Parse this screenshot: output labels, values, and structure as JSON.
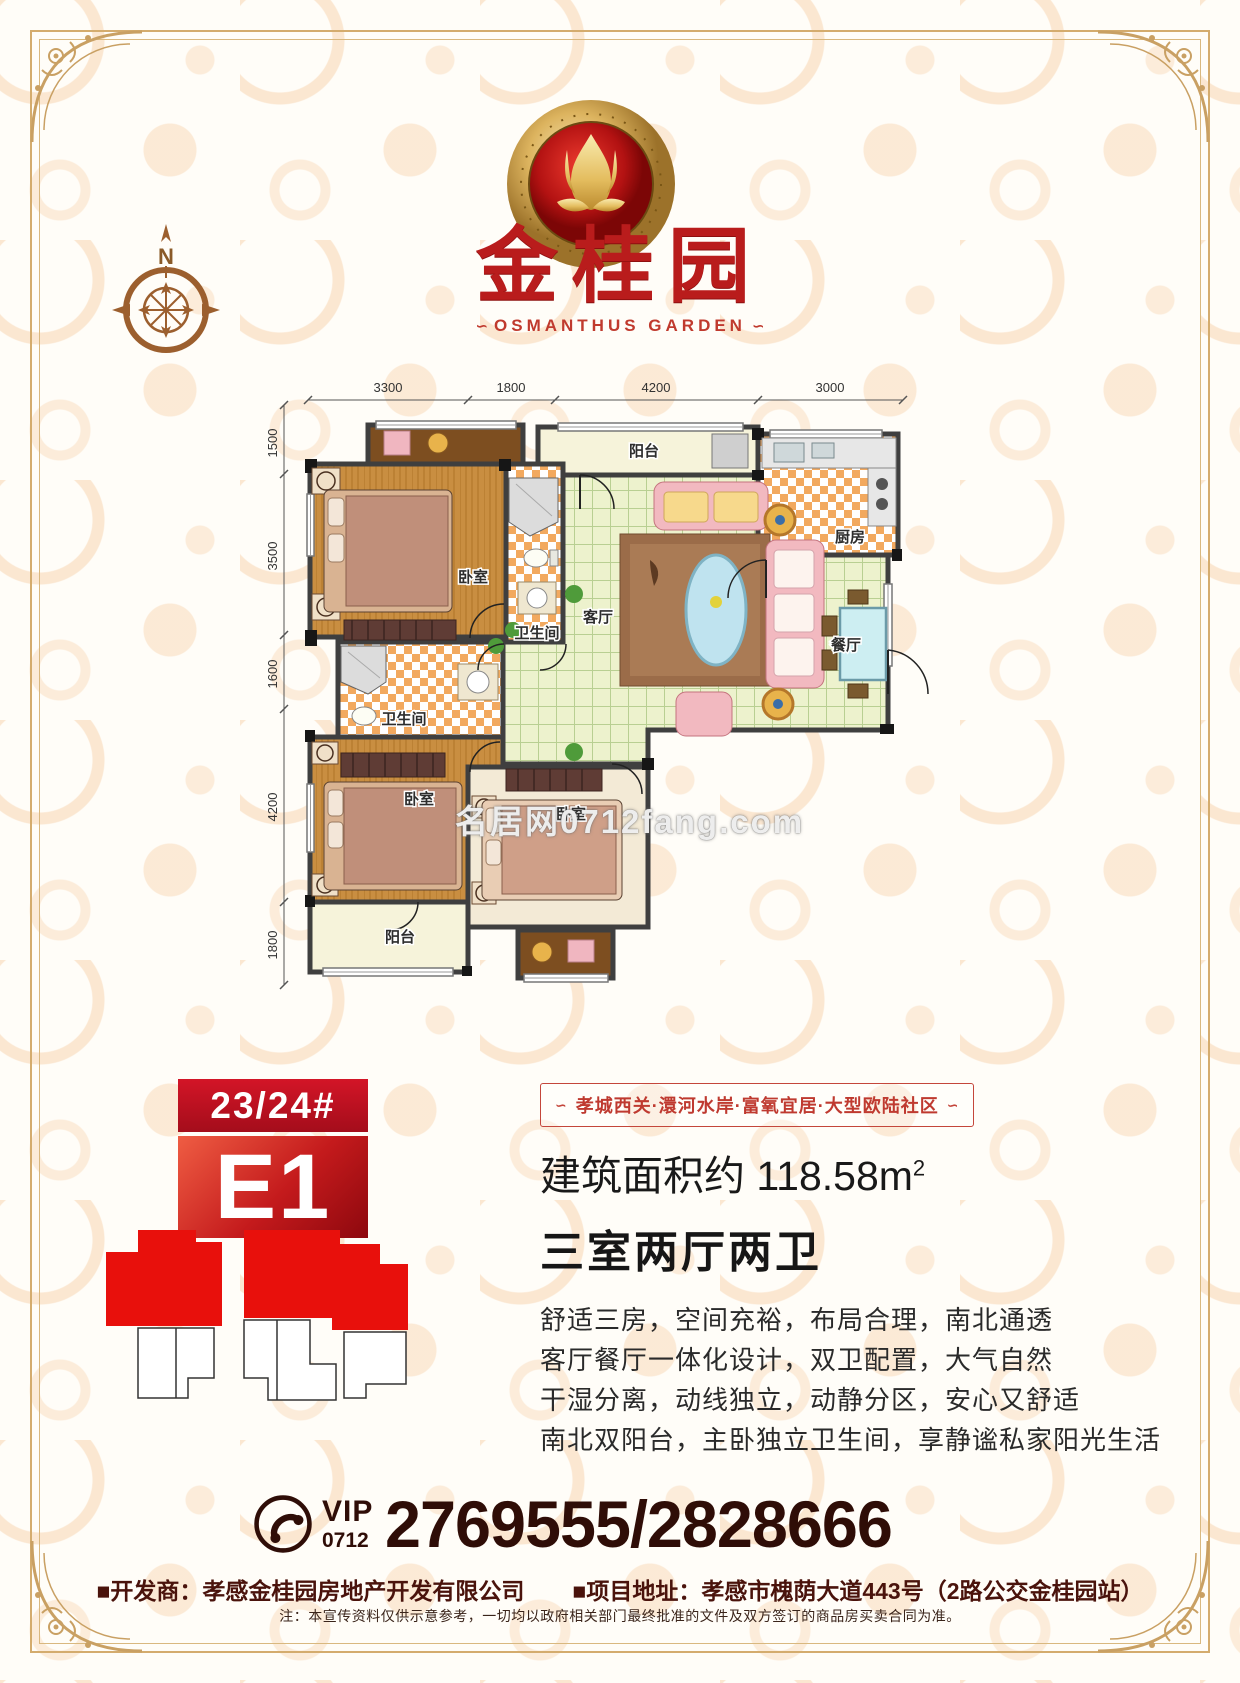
{
  "page": {
    "title_cn": "金桂园",
    "title_en": "OSMANTHUS GARDEN",
    "title_flourish": "∽",
    "compass_label": "N",
    "watermark": "名居网0712fang.com"
  },
  "plan": {
    "dims_top": [
      "3300",
      "1800",
      "4200",
      "3000"
    ],
    "dims_left": [
      "1500",
      "3500",
      "1600",
      "4200",
      "1800"
    ],
    "rooms": {
      "balcony_top": "阳台",
      "kitchen": "厨房",
      "living": "客厅",
      "dining": "餐厅",
      "bedroom_master": "卧室",
      "bath1": "卫生间",
      "bath2": "卫生间",
      "bedroom2": "卧室",
      "bedroom3": "卧室",
      "balcony_bottom": "阳台"
    }
  },
  "badge": {
    "building": "23/24#",
    "unit": "E1"
  },
  "banner": {
    "text": "孝城西关·澴河水岸·富氧宜居·大型欧陆社区",
    "flourish": "∽"
  },
  "details": {
    "area_label": "建筑面积约 118.58m",
    "area_sup": "2",
    "layout": "三室两厅两卫",
    "desc_lines": [
      "舒适三房，空间充裕，布局合理，南北通透",
      "客厅餐厅一体化设计，双卫配置，大气自然",
      "干湿分离，动线独立，动静分区，安心又舒适",
      "南北双阳台，主卧独立卫生间，享静谧私家阳光生活"
    ]
  },
  "contact": {
    "vip": "VIP",
    "area_code": "0712",
    "phone": "2769555/2828666"
  },
  "footer": {
    "developer": "■开发商：孝感金桂园房地产开发有限公司",
    "address": "■项目地址：孝感市槐荫大道443号（2路公交金桂园站）",
    "note": "注：本宣传资料仅供示意参考，一切均以政府相关部门最终批准的文件及双方签订的商品房买卖合同为准。"
  },
  "colors": {
    "brand_red": "#b91c1c",
    "badge_red": "#c41a1c",
    "gold": "#c9a063",
    "phone_brown": "#2f0d07",
    "tile_orange": "#f2a95f",
    "floor_green": "#edf2cd",
    "wood": "#c98e41"
  }
}
